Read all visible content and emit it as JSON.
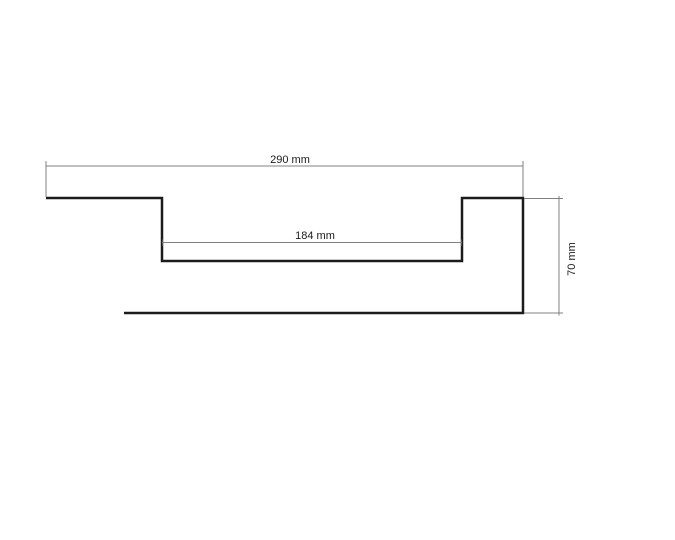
{
  "drawing": {
    "unit": "mm",
    "dimension_labels": {
      "overall_width": "290 mm",
      "inner_width": "184 mm",
      "height": "70 mm"
    },
    "dimension_values": {
      "overall_width_mm": 290,
      "inner_width_mm": 184,
      "height_mm": 70
    },
    "colors": {
      "background": "#ffffff",
      "profile_outline": "#1c1c1c",
      "dimension_line": "#808080",
      "label_text": "#1a1a1a"
    }
  }
}
